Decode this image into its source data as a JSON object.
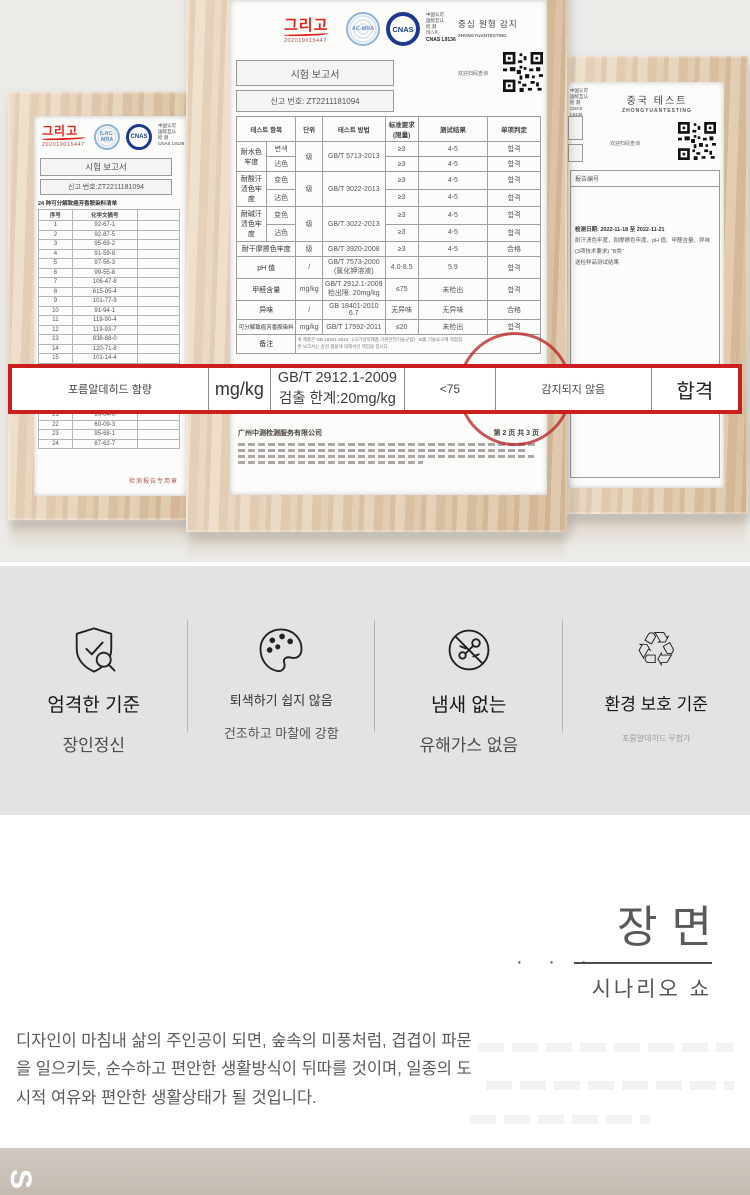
{
  "colors": {
    "accent_red": "#cb1f1f",
    "logo_red": "#e1251b",
    "stamp_blue": "#1b3a8f"
  },
  "left_cert": {
    "logo": "그리고",
    "logo_no": "202019015447",
    "stamp1": "ILAC-MRA",
    "stamp2": "CNAS",
    "side": "中国认可\n国际互认\n检 测\nCNAS L9136",
    "title": "시험 보고서",
    "report_no": "신고 번호:ZT2211181094",
    "note": "24 种可分解致癌芳香胺染料清单",
    "col1": "序号",
    "col2": "化学文摘号",
    "rows": [
      [
        "1",
        "92-67-1"
      ],
      [
        "2",
        "92-87-5"
      ],
      [
        "3",
        "95-69-2"
      ],
      [
        "4",
        "91-59-8"
      ],
      [
        "5",
        "97-56-3"
      ],
      [
        "6",
        "99-55-8"
      ],
      [
        "7",
        "106-47-8"
      ],
      [
        "8",
        "615-05-4"
      ],
      [
        "9",
        "101-77-9"
      ],
      [
        "10",
        "91-94-1"
      ],
      [
        "11",
        "119-90-4"
      ],
      [
        "12",
        "119-93-7"
      ],
      [
        "13",
        "838-88-0"
      ],
      [
        "14",
        "120-71-8"
      ],
      [
        "15",
        "101-14-4"
      ],
      [
        "16",
        "101-80-4"
      ],
      [
        "17",
        "139-65-1"
      ],
      [
        "18",
        "95-53-4"
      ],
      [
        "19",
        "95-80-7"
      ],
      [
        "20",
        "137-17-7"
      ],
      [
        "21",
        "90-04-0"
      ],
      [
        "22",
        "60-09-3"
      ],
      [
        "23",
        "95-68-1"
      ],
      [
        "24",
        "87-62-7"
      ]
    ],
    "stamp_footer": "检测报告专用章"
  },
  "center_cert": {
    "logo": "그리고",
    "logo_no": "202019015447",
    "stamp1": "AC-MRA",
    "stamp2": "CNAS",
    "side_lines": "中国认可\n国际互认\n检 测\n테스트",
    "side_bold": "CNAS L9136",
    "title": "시험 보고서",
    "report_no": "신고 번호: ZT2211181094",
    "right_title": "중심 원형 감지",
    "right_sub": "ZHONGYUANTESTING",
    "qr_caption": "欢迎扫码查询",
    "th": {
      "item": "테스트 항목",
      "unit": "단위",
      "method": "테스트 방법",
      "std": "标准要求\n(限量)",
      "result": "测试结果",
      "judge": "单项判定"
    },
    "g1": {
      "item": "耐水色牢度",
      "unit": "级",
      "method": "GB/T 5713-2013",
      "r1": {
        "sub": "변색",
        "std": "≥3",
        "res": "4-5",
        "judge": "합격"
      },
      "r2": {
        "sub": "沾色",
        "std": "≥3",
        "res": "4-5",
        "judge": "합격"
      }
    },
    "g2": {
      "item": "耐酸汗渍色牢度",
      "unit": "级",
      "method": "GB/T 3022-2013",
      "r1": {
        "sub": "变色",
        "std": "≥3",
        "res": "4-5",
        "judge": "합격"
      },
      "r2": {
        "sub": "沾色",
        "std": "≥3",
        "res": "4-5",
        "judge": "합격"
      }
    },
    "g3": {
      "item": "耐碱汗渍色牢度",
      "unit": "级",
      "method": "GB/T 3022-2013",
      "r1": {
        "sub": "变色",
        "std": "≥3",
        "res": "4-5",
        "judge": "합격"
      },
      "r2": {
        "sub": "沾色",
        "std": "≥3",
        "res": "4-5",
        "judge": "합격"
      }
    },
    "s1": {
      "item": "耐干摩擦色牢度",
      "unit": "级",
      "method": "GB/T 3920-2008",
      "std": "≥3",
      "res": "4-5",
      "judge": "合格"
    },
    "s2": {
      "item": "pH 值",
      "unit": "/",
      "method": "GB/T 7573-2000\n(氯化钾溶液)",
      "std": "4.0-8.5",
      "res": "5.9",
      "judge": "합격"
    },
    "s3": {
      "item": "甲醛含量",
      "unit": "mg/kg",
      "method": "GB/T 2912.1-2009\n检出限: 20mg/kg",
      "std": "≤75",
      "res": "未检出",
      "judge": "합격"
    },
    "s4": {
      "item": "异味",
      "unit": "/",
      "method": "GB 18401-2010\n6.7",
      "std": "无异味",
      "res": "无异味",
      "judge": "合格"
    },
    "s5": {
      "item": "可分解致癌芳香胺染料",
      "unit": "mg/kg",
      "method": "GB/T 17592-2011",
      "std": "≤20",
      "res": "未检出",
      "judge": "합격"
    },
    "remark": {
      "label": "备注",
      "text": "위 제품은 GB 18401-2010 《국가방직제품 기본안전기술규범》 B类 기술요구에 적합함.\n본 보고서는 송검 샘플에 대해서만 책임을 집니다."
    },
    "footer_company": "广州中测检测服务有限公司",
    "footer_page": "第 2 页 共 3 页",
    "seal_star": "★"
  },
  "right_cert": {
    "side": "中国认可\n国际互认\n检 测\nCNAS L9136",
    "title": "중국 테스트",
    "sub": "ZHONGYUANTESTING",
    "qr_caption": "欢迎扫码查询",
    "box_label": "报告编号",
    "lines": [
      "检测日期: 2022-11-18 至 2022-11-21",
      "耐汗渍色牢度、耐摩擦色牢度、pH 值、甲醛含量、异味",
      "(3项技术要求) “B类”",
      "送检样品测试结果"
    ]
  },
  "highlight_row": {
    "item": "포름알데히드 함량",
    "unit": "mg/kg",
    "method": "GB/T 2912.1-2009\n검출 한계:20mg/kg",
    "standard": "<75",
    "result": "감지되지 않음",
    "judge": "합격"
  },
  "features": {
    "items": [
      {
        "icon": "shield-check-magnifier",
        "title": "엄격한 기준",
        "subtitle": "장인정신"
      },
      {
        "icon": "palette",
        "title": "퇴색하기 쉽지 않음",
        "subtitle": "건조하고 마찰에 강함"
      },
      {
        "icon": "no-odor",
        "title": "냄새 없는",
        "subtitle": "유해가스 없음"
      },
      {
        "icon": "recycle",
        "title": "환경 보호 기준",
        "subtitle": "포름알데히드 무첨가",
        "glyph": "♲"
      }
    ]
  },
  "scene": {
    "title": "장면",
    "dots": "· · ·",
    "subtitle": "시나리오 쇼",
    "paragraph": "디자인이 마침내 삶의 주인공이 되면, 숲속의 미풍처럼, 겹겹이 파문을 일으키듯, 순수하고 편안한 생활방식이 뒤따를 것이며, 일종의 도시적 여유와 편안한 생활상태가 될 것입니다."
  },
  "footer_band": {
    "letter": "S"
  }
}
